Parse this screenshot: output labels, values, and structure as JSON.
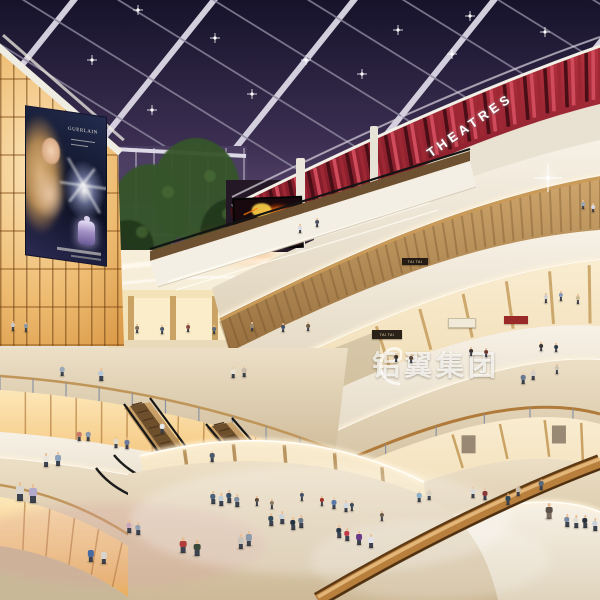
{
  "scene_title": "Multi-level shopping mall atrium interior at night",
  "signs": {
    "theatres": "THEATRES",
    "billboard_brand": "GUERLAIN",
    "store_tai_tai_upper": "TAI TAI",
    "store_tai_tai_lower": "TAI TAI",
    "watermark": "铝翼集团"
  },
  "colors": {
    "sky_top": "#16132b",
    "sky_mid": "#3c2f52",
    "sky_bottom": "#57456b",
    "beam_white": "#ddd9e6",
    "beam_thin": "#8f8aa0",
    "theatre_red": "#9e2734",
    "theatre_red_light": "#d04b5c",
    "theatre_red_dark": "#4a0e16",
    "fascia_cream_hi": "#f7f1e6",
    "fascia_cream_lo": "#e0d4bd",
    "cove_glow": "#fff3da",
    "cove_core": "#fffef8",
    "wood_hi": "#cfa76d",
    "wood_lo": "#976f3f",
    "shop_warm_hi": "#f9ecd0",
    "shop_warm_lo": "#eed9ae",
    "floor_hi": "#ecdfc6",
    "floor_lo": "#cdb997",
    "fire_hot": "#ffd24a",
    "fire_mid": "#ff7a10",
    "fire_deep": "#8c1e06",
    "glow_panel_hi": "#fde7b8",
    "glow_panel_lo": "#e7ad58",
    "tree_green": "#35552c",
    "tree_dark": "#24391f",
    "rail_wood": "#b97f3d",
    "rail_hi": "#e6bc7e",
    "rail_dark": "#5e3a14",
    "skin": "#e9bd93"
  },
  "people": [
    [
      20,
      501,
      19,
      "#d9d5cd"
    ],
    [
      33,
      503,
      19,
      "#b3aacb"
    ],
    [
      46,
      467,
      14,
      "#e9e5db"
    ],
    [
      58,
      466,
      14,
      "#8aa2ba"
    ],
    [
      79,
      441,
      11,
      "#c87868"
    ],
    [
      88,
      441,
      11,
      "#8a9aaa"
    ],
    [
      116,
      448,
      12,
      "#e2dac9"
    ],
    [
      127,
      449,
      12,
      "#6a7a9a"
    ],
    [
      62,
      376,
      11,
      "#9aaaba"
    ],
    [
      101,
      381,
      13,
      "#b9c9d9"
    ],
    [
      233,
      378,
      11,
      "#e9e1d1"
    ],
    [
      244,
      377,
      11,
      "#c9b9a9"
    ],
    [
      13,
      331,
      10,
      "#c9c9c9"
    ],
    [
      26,
      332,
      10,
      "#8a9aaa"
    ],
    [
      137,
      333,
      9,
      "#7a6a5a"
    ],
    [
      162,
      334,
      9,
      "#4a5a6a"
    ],
    [
      188,
      332,
      9,
      "#8a4a42"
    ],
    [
      214,
      334,
      9,
      "#5a6a7a"
    ],
    [
      252,
      331,
      9,
      "#9a8a72"
    ],
    [
      283,
      332,
      9,
      "#42526a"
    ],
    [
      308,
      331,
      9,
      "#6a5a4a"
    ],
    [
      162,
      433,
      11,
      "#e9e9e9"
    ],
    [
      212,
      462,
      11,
      "#4a5a6a"
    ],
    [
      300,
      233,
      9,
      "#d9d9e2"
    ],
    [
      317,
      227,
      9,
      "#4a5262"
    ],
    [
      213,
      504,
      13,
      "#48607a"
    ],
    [
      221,
      506,
      13,
      "#c1cdd9"
    ],
    [
      229,
      503,
      13,
      "#395069"
    ],
    [
      237,
      507,
      13,
      "#8191a1"
    ],
    [
      183,
      553,
      16,
      "#b13a3a"
    ],
    [
      197,
      556,
      16,
      "#3a4a3a"
    ],
    [
      241,
      549,
      15,
      "#c9c5bd"
    ],
    [
      249,
      546,
      15,
      "#8a9aaa"
    ],
    [
      271,
      526,
      13,
      "#314959"
    ],
    [
      282,
      524,
      13,
      "#c9d1d9"
    ],
    [
      293,
      530,
      13,
      "#213141"
    ],
    [
      301,
      528,
      13,
      "#697989"
    ],
    [
      334,
      509,
      12,
      "#597aa9"
    ],
    [
      346,
      512,
      12,
      "#d1d9e1"
    ],
    [
      339,
      538,
      13,
      "#293949"
    ],
    [
      347,
      541,
      13,
      "#c13949"
    ],
    [
      359,
      545,
      14,
      "#6a3a8a"
    ],
    [
      371,
      548,
      14,
      "#e1e1e9"
    ],
    [
      419,
      502,
      11,
      "#8ab1c9"
    ],
    [
      429,
      500,
      11,
      "#d9d1c1"
    ],
    [
      91,
      562,
      15,
      "#4869a1"
    ],
    [
      104,
      564,
      15,
      "#d9d5cd"
    ],
    [
      129,
      533,
      13,
      "#c9a9b9"
    ],
    [
      138,
      535,
      13,
      "#91a1b1"
    ],
    [
      473,
      498,
      12,
      "#d9d9d9"
    ],
    [
      485,
      500,
      12,
      "#893939"
    ],
    [
      508,
      505,
      12,
      "#314959"
    ],
    [
      518,
      496,
      11,
      "#c9bea9"
    ],
    [
      541,
      490,
      11,
      "#596979"
    ],
    [
      549,
      519,
      16,
      "#5a5048",
      "#7a6c5e"
    ],
    [
      567,
      527,
      13,
      "#7989a1"
    ],
    [
      576,
      528,
      13,
      "#e1ded6"
    ],
    [
      585,
      528,
      13,
      "#293039"
    ],
    [
      595,
      531,
      13,
      "#c9d1d9"
    ],
    [
      523,
      384,
      11,
      "#697991"
    ],
    [
      533,
      380,
      11,
      "#d9d1c9"
    ],
    [
      557,
      374,
      10,
      "#c9c1b1"
    ],
    [
      546,
      303,
      10,
      "#d1d1d1"
    ],
    [
      561,
      301,
      10,
      "#8a99b9"
    ],
    [
      578,
      304,
      10,
      "#c9b991"
    ],
    [
      583,
      209,
      9,
      "#99a9b9"
    ],
    [
      593,
      212,
      9,
      "#d9d9e1"
    ],
    [
      396,
      362,
      9,
      "#3a3230"
    ],
    [
      411,
      363,
      9,
      "#54443a"
    ],
    [
      471,
      356,
      9,
      "#3a3230"
    ],
    [
      486,
      357,
      9,
      "#6a3a32"
    ],
    [
      541,
      351,
      9,
      "#3a3230"
    ],
    [
      556,
      352,
      9,
      "#2a3a4a"
    ],
    [
      257,
      506,
      10,
      "#5a4a3a"
    ],
    [
      272,
      509,
      10,
      "#8a7a62"
    ],
    [
      302,
      501,
      10,
      "#42526a"
    ],
    [
      322,
      506,
      10,
      "#a13028"
    ],
    [
      352,
      511,
      10,
      "#3a4a5a"
    ],
    [
      382,
      521,
      10,
      "#6a5a4a"
    ]
  ]
}
